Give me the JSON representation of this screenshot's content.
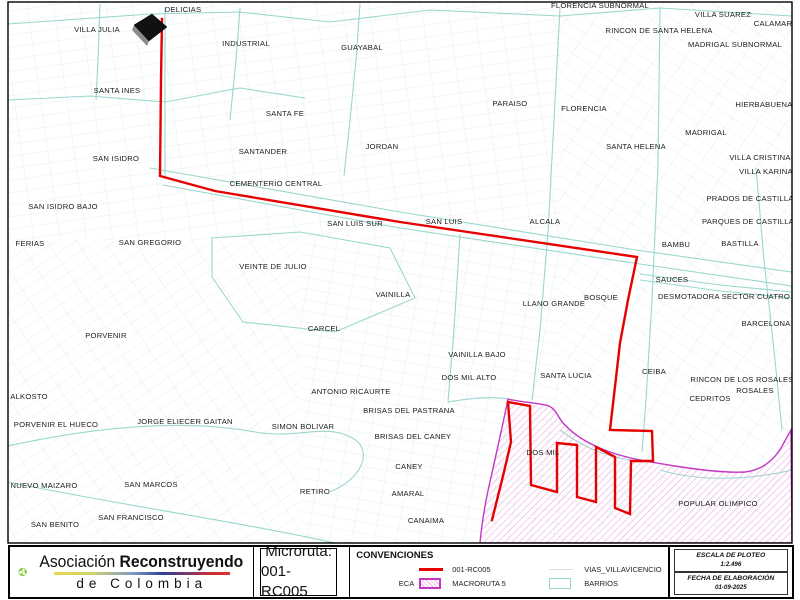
{
  "map": {
    "route_id": "001-RC005",
    "colors": {
      "route": "#e60000",
      "barrios_line": "#9ad6cf",
      "vias_line": "#dcefec",
      "vias_legend_line": "#d9dfe1",
      "macroruta_border": "#c438c4",
      "macroruta_hatch": "#f2b0e4"
    },
    "labels": [
      {
        "t": "DELICIAS",
        "x": 183,
        "y": 12
      },
      {
        "t": "VILLA JULIA",
        "x": 97,
        "y": 32
      },
      {
        "t": "INDUSTRIAL",
        "x": 246,
        "y": 46
      },
      {
        "t": "GUAYABAL",
        "x": 362,
        "y": 50
      },
      {
        "t": "FLORENCIA SUBNORMAL",
        "x": 600,
        "y": 8
      },
      {
        "t": "VILLA SUAREZ",
        "x": 723,
        "y": 17
      },
      {
        "t": "CALAMAR",
        "x": 773,
        "y": 26
      },
      {
        "t": "RINCON DE SANTA HELENA",
        "x": 659,
        "y": 33
      },
      {
        "t": "MADRIGAL SUBNORMAL",
        "x": 735,
        "y": 47
      },
      {
        "t": "SANTA INES",
        "x": 117,
        "y": 93
      },
      {
        "t": "SANTA FE",
        "x": 285,
        "y": 116
      },
      {
        "t": "PARAISO",
        "x": 510,
        "y": 106
      },
      {
        "t": "FLORENCIA",
        "x": 584,
        "y": 111
      },
      {
        "t": "HIERBABUENA",
        "x": 764,
        "y": 107
      },
      {
        "t": "MADRIGAL",
        "x": 706,
        "y": 135
      },
      {
        "t": "SANTA HELENA",
        "x": 636,
        "y": 149
      },
      {
        "t": "VILLA CRISTINA",
        "x": 760,
        "y": 160
      },
      {
        "t": "VILLA KARINA",
        "x": 766,
        "y": 174
      },
      {
        "t": "JORDAN",
        "x": 382,
        "y": 149
      },
      {
        "t": "SANTANDER",
        "x": 263,
        "y": 154
      },
      {
        "t": "SAN ISIDRO",
        "x": 116,
        "y": 161
      },
      {
        "t": "CEMENTERIO CENTRAL",
        "x": 276,
        "y": 186
      },
      {
        "t": "SAN ISIDRO BAJO",
        "x": 63,
        "y": 209
      },
      {
        "t": "FERIAS",
        "x": 30,
        "y": 246
      },
      {
        "t": "SAN GREGORIO",
        "x": 150,
        "y": 245
      },
      {
        "t": "SAN LUIS SUR",
        "x": 355,
        "y": 226
      },
      {
        "t": "SAN LUIS",
        "x": 444,
        "y": 224
      },
      {
        "t": "ALCALA",
        "x": 545,
        "y": 224
      },
      {
        "t": "PRADOS DE CASTILLA",
        "x": 750,
        "y": 201
      },
      {
        "t": "PARQUES DE CASTILLA",
        "x": 748,
        "y": 224
      },
      {
        "t": "BAMBU",
        "x": 676,
        "y": 247
      },
      {
        "t": "BASTILLA",
        "x": 740,
        "y": 246
      },
      {
        "t": "VEINTE DE JULIO",
        "x": 273,
        "y": 269
      },
      {
        "t": "SAUCES",
        "x": 672,
        "y": 282
      },
      {
        "t": "DESMOTADORA SECTOR CUATRO",
        "x": 724,
        "y": 299
      },
      {
        "t": "VAINILLA",
        "x": 393,
        "y": 297
      },
      {
        "t": "LLANO GRANDE",
        "x": 554,
        "y": 306
      },
      {
        "t": "BOSQUE",
        "x": 601,
        "y": 300
      },
      {
        "t": "BARCELONA",
        "x": 766,
        "y": 326
      },
      {
        "t": "CARCEL",
        "x": 324,
        "y": 331
      },
      {
        "t": "PORVENIR",
        "x": 106,
        "y": 338
      },
      {
        "t": "VAINILLA BAJO",
        "x": 477,
        "y": 357
      },
      {
        "t": "DOS MIL ALTO",
        "x": 469,
        "y": 380
      },
      {
        "t": "SANTA LUCIA",
        "x": 566,
        "y": 378
      },
      {
        "t": "CEIBA",
        "x": 654,
        "y": 374
      },
      {
        "t": "RINCON DE LOS ROSALES",
        "x": 742,
        "y": 382
      },
      {
        "t": "ROSALES",
        "x": 755,
        "y": 393
      },
      {
        "t": "CEDRITOS",
        "x": 710,
        "y": 401
      },
      {
        "t": "ALKOSTO",
        "x": 29,
        "y": 399
      },
      {
        "t": "ANTONIO RICAURTE",
        "x": 351,
        "y": 394
      },
      {
        "t": "PORVENIR EL HUECO",
        "x": 56,
        "y": 427
      },
      {
        "t": "JORGE ELIECER GAITAN",
        "x": 185,
        "y": 424
      },
      {
        "t": "SIMON BOLIVAR",
        "x": 303,
        "y": 429
      },
      {
        "t": "BRISAS DEL PASTRANA",
        "x": 409,
        "y": 413
      },
      {
        "t": "BRISAS DEL CANEY",
        "x": 413,
        "y": 439
      },
      {
        "t": "NUEVO MAIZARO",
        "x": 44,
        "y": 488
      },
      {
        "t": "SAN MARCOS",
        "x": 151,
        "y": 487
      },
      {
        "t": "RETIRO",
        "x": 315,
        "y": 494
      },
      {
        "t": "CANEY",
        "x": 409,
        "y": 469
      },
      {
        "t": "AMARAL",
        "x": 408,
        "y": 496
      },
      {
        "t": "SAN FRANCISCO",
        "x": 131,
        "y": 520
      },
      {
        "t": "SAN BENITO",
        "x": 55,
        "y": 527
      },
      {
        "t": "CANAIMA",
        "x": 426,
        "y": 523
      },
      {
        "t": "DOS MIL",
        "x": 543,
        "y": 455
      },
      {
        "t": "POPULAR OLIMPICO",
        "x": 718,
        "y": 506
      }
    ]
  },
  "footer": {
    "logo": {
      "line1_regular": "Asociación",
      "line1_bold": "Reconstruyendo",
      "line2": "de Colombia"
    },
    "microruta": {
      "label": "Microruta:",
      "value": "001-RC005"
    },
    "legend": {
      "title": "CONVENCIONES",
      "route_label": "001-RC005",
      "vias_label": "VIAS_VILLAVICENCIO",
      "eca_label": "ECA",
      "macroruta_label": "MACRORUTA 5",
      "barrios_label": "BARRIOS"
    },
    "escala": {
      "title": "ESCALA DE PLOTEO",
      "value": "1:2.496"
    },
    "fecha": {
      "title": "FECHA DE ELABORACIÓN",
      "value": "01-09-2025"
    }
  }
}
